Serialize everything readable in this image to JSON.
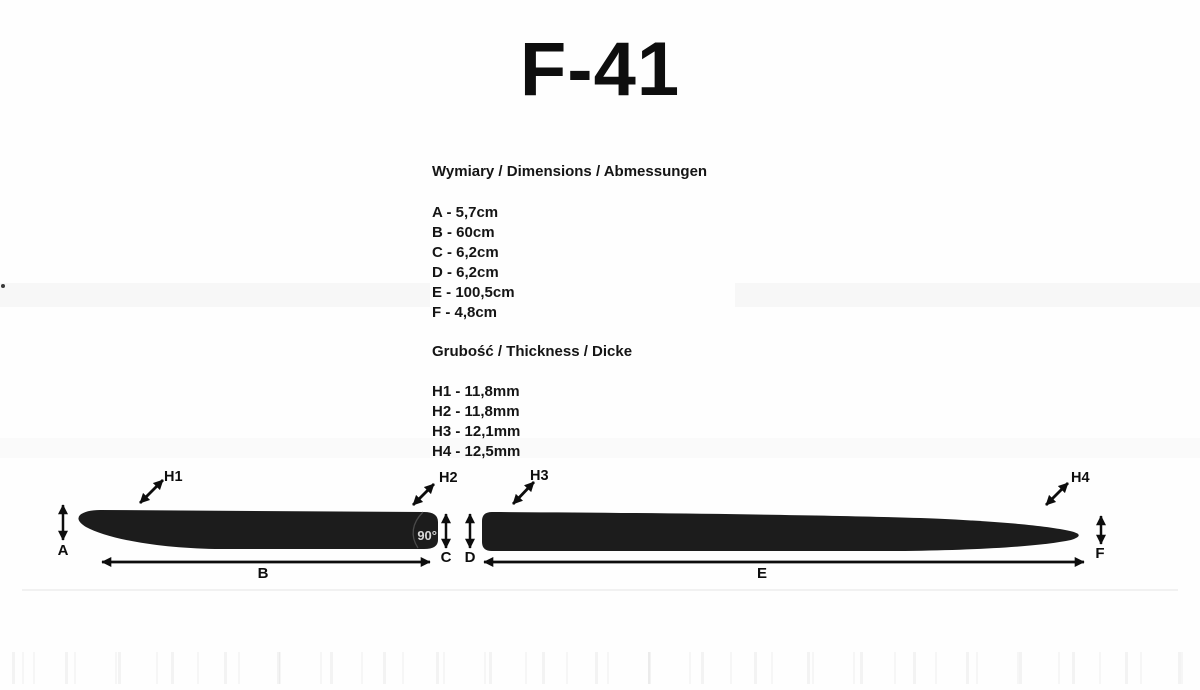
{
  "title": "F-41",
  "sections": {
    "dimensions": {
      "heading": "Wymiary / Dimensions / Abmessungen",
      "items": [
        "A - 5,7cm",
        "B - 60cm",
        "C - 6,2cm",
        "D - 6,2cm",
        "E - 100,5cm",
        "F - 4,8cm"
      ]
    },
    "thickness": {
      "heading": "Grubość / Thickness / Dicke",
      "items": [
        "H1 - 11,8mm",
        "H2 - 11,8mm",
        "H3 - 12,1mm",
        "H4 - 12,5mm"
      ]
    }
  },
  "diagram": {
    "labels": {
      "h1": "H1",
      "h2": "H2",
      "h3": "H3",
      "h4": "H4",
      "a": "A",
      "b": "B",
      "c": "C",
      "d": "D",
      "e": "E",
      "f": "F",
      "angle": "90°"
    }
  },
  "colors": {
    "strip_fill": "#1c1c1c",
    "arrow": "#0d0d0d",
    "angle_text": "#d8d8d8",
    "text": "#151515",
    "background": "#fefefe"
  }
}
